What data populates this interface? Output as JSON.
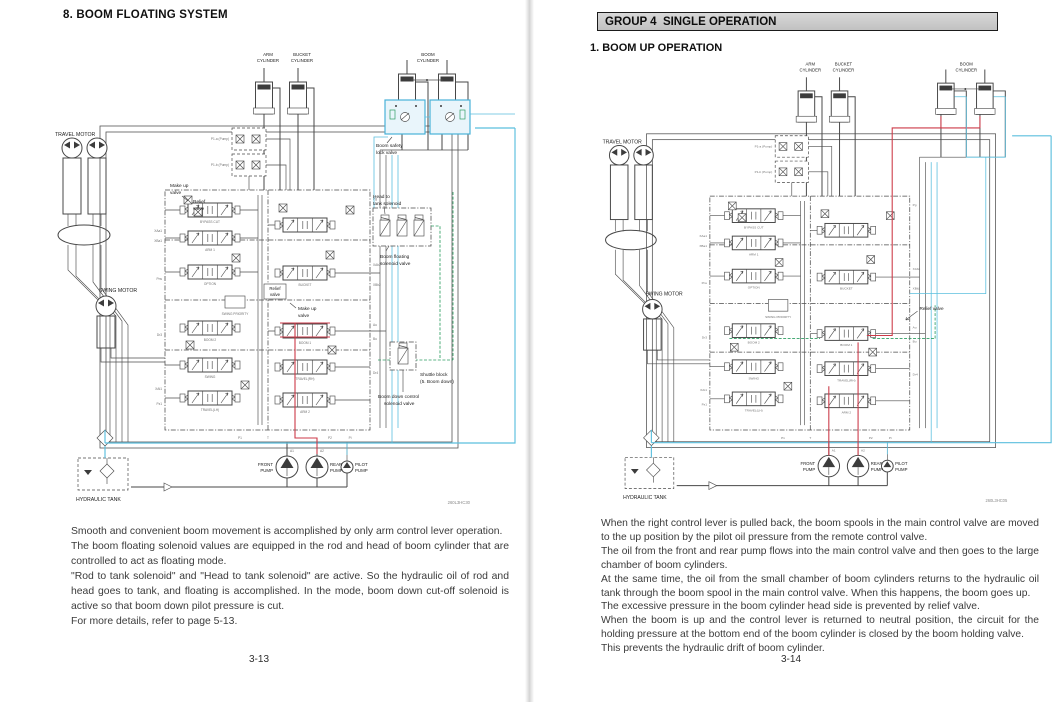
{
  "shared_diagram": {
    "arm_cylinder": [
      "ARM",
      "CYLINDER"
    ],
    "bucket_cylinder": [
      "BUCKET",
      "CYLINDER"
    ],
    "boom_cylinder": [
      "BOOM",
      "CYLINDER"
    ],
    "travel_motor": "TRAVEL MOTOR",
    "swing_motor": "SWING MOTOR",
    "hydraulic_tank": "HYDRAULIC TANK",
    "front_pump": [
      "FRONT",
      "PUMP"
    ],
    "rear_pump": [
      "REAR",
      "PUMP"
    ],
    "pilot_pump": [
      "PILOT",
      "PUMP"
    ],
    "a1": "A1",
    "a2": "A2",
    "pilot_line_1": "P1-a (Pump)",
    "pilot_line_2": "P1-b (Pump)",
    "spools_left": [
      "BYPASS CUT",
      "ARM 1",
      "OPTION",
      "SWING PRIORITY",
      "BOOM 2",
      "SWING",
      "TRAVEL(LH)"
    ],
    "spools_right": [
      "BUCKET",
      "BOOM 1",
      "TRAVEL(RH)",
      "ARM 2"
    ],
    "ports_left": [
      "XAa1",
      "XBa1",
      "Pns",
      "Dr3",
      "XAt1",
      "Pz1"
    ],
    "ports_right": [
      "Pg",
      "XAb2",
      "XBb2",
      "Au",
      "Bu",
      "Dr4"
    ],
    "ports_bottom": [
      "P1",
      "T",
      "P2",
      "Pi"
    ]
  },
  "left_page": {
    "title": "8. BOOM FLOATING SYSTEM",
    "callouts": {
      "make_up_valve_1": [
        "Make up",
        "valve"
      ],
      "relief_valve_1": [
        "Relief",
        "valve"
      ],
      "relief_valve_2": [
        "Relief",
        "valve"
      ],
      "make_up_valve_2": [
        "Make up",
        "valve"
      ],
      "head_to_tank": [
        "Head to",
        "tank solenoid"
      ],
      "boom_floating": [
        "Boom floating",
        "solenoid valve"
      ],
      "boom_safety": [
        "Boom safety",
        "lock valve"
      ],
      "shuttle_block": [
        "Shuttle block",
        "(5. Boom down)"
      ],
      "boom_down_control": [
        "Boom down control",
        "solenoid valve"
      ]
    },
    "code": "260L3HC30",
    "paragraphs": [
      "Smooth and convenient boom movement is accomplished by only arm control lever operation.",
      "The boom floating solenoid values are equipped in the rod and head of boom cylinder that are controlled to act as floating mode.",
      "\"Rod to tank solenoid\" and \"Head to tank solenoid\" are active. So the hydraulic oil of rod and head goes to tank, and floating is accomplished. In the mode, boom down cut-off solenoid is active so that boom down pilot pressure is cut.",
      "For more details, refer to page 5-13."
    ],
    "page_number": "3-13"
  },
  "right_page": {
    "group_header": "GROUP 4  SINGLE OPERATION",
    "title": "1. BOOM UP OPERATION",
    "callouts": {
      "relief_valve": "Relief valve"
    },
    "code": "260L3HC05",
    "paragraphs": [
      "When the right control lever is pulled back, the boom spools in the main control valve are moved to the up position by the pilot oil pressure from the remote control valve.",
      "The oil from the front and rear pump flows into the main control valve and then goes to the large chamber of boom cylinders.",
      "At the same time, the oil from the small chamber of boom cylinders returns to the hydraulic oil tank through the boom spool in the main control valve.  When this happens, the boom goes up.",
      "The excessive pressure in the boom cylinder head side is prevented by relief valve.",
      "When the boom is up and the control lever is returned to neutral position, the circuit for the holding pressure at the bottom end of the boom cylinder is closed by the boom holding valve.",
      "This prevents the hydraulic drift of boom cylinder."
    ],
    "page_number": "3-14"
  },
  "colors": {
    "line": "#474747",
    "cyan": "#5bbfde",
    "red": "#cc3a48",
    "green": "#2f9e63",
    "header_bg": "#c9c9c9"
  }
}
